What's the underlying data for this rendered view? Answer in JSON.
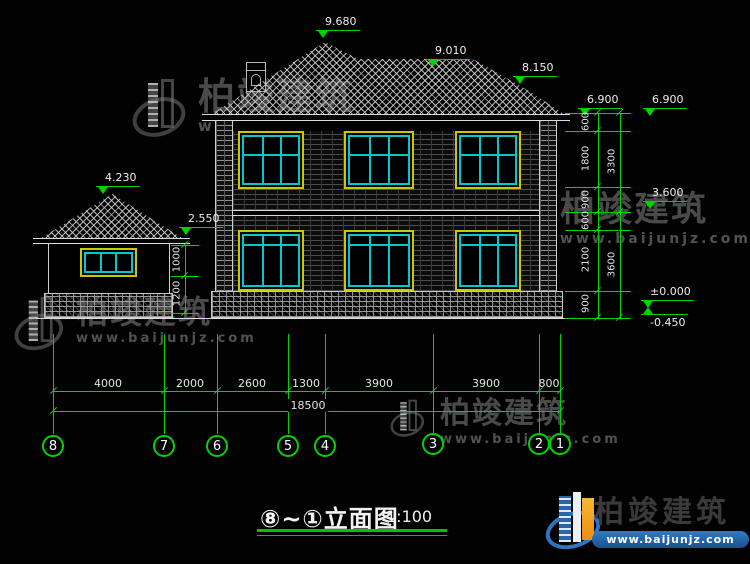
{
  "watermark": {
    "brand": "柏竣建筑",
    "url": "www.baijunjz.com"
  },
  "logo": {
    "brand": "柏竣建筑",
    "url": "www.baijunjz.com"
  },
  "title": {
    "name": "⑧~①立面图",
    "scale": "1:100"
  },
  "levels": {
    "peak": "9.680",
    "ridge": "9.010",
    "hip": "8.150",
    "eave_a": "6.900",
    "eave_b": "6.900",
    "second": "3.600",
    "zero": "±0.000",
    "ground": "-0.450",
    "garage_peak": "4.230",
    "garage_eave": "2.550"
  },
  "right_chain": {
    "segments": [
      "600",
      "1800",
      "900",
      "600",
      "2100",
      "900"
    ],
    "totals": [
      "3300",
      "3600"
    ]
  },
  "left_chain": {
    "segments": [
      "1000",
      "1200"
    ]
  },
  "bottom_chain": {
    "segments": [
      "4000",
      "2000",
      "2600",
      "1300",
      "3900",
      "3900",
      "800"
    ],
    "total": "18500"
  },
  "grids": [
    "8",
    "7",
    "6",
    "5",
    "4",
    "3",
    "2",
    "1"
  ],
  "colors": {
    "dim_green": "#00d400",
    "outline_white": "#dcdcdc",
    "window_frame": "#c9c900",
    "window_mullion": "#00c9c9",
    "logo_blue": "#2f75c2",
    "logo_orange": "#ec8c15"
  }
}
